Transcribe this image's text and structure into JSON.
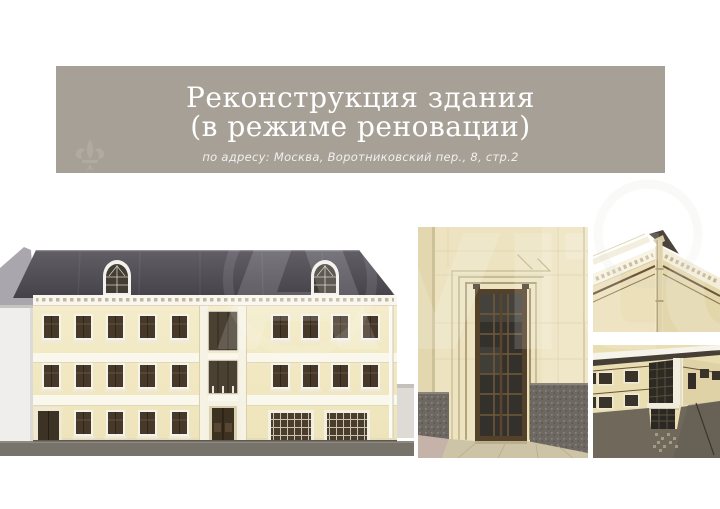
{
  "banner": {
    "background_color": "#a7a097",
    "text_color": "#ffffff",
    "title_line1": "Реконструкция здания",
    "title_line2": "(в режиме реновации)",
    "subtitle": "по адресу: Москва, Воротниковский пер., 8, стр.2"
  },
  "watermark": {
    "text": "Avito"
  },
  "gallery": {
    "images": [
      {
        "name": "main-elevation-render"
      },
      {
        "name": "entrance-portal-render"
      },
      {
        "name": "cornice-corner-render"
      },
      {
        "name": "courtyard-view-render"
      }
    ],
    "colors": {
      "facade_cream": "#f3ebc9",
      "roof_gray": "#504d55",
      "window_brown": "#46392a",
      "granite_gray": "#6e6862",
      "ground_gray": "#77736a",
      "banner_taupe": "#a7a097"
    }
  }
}
